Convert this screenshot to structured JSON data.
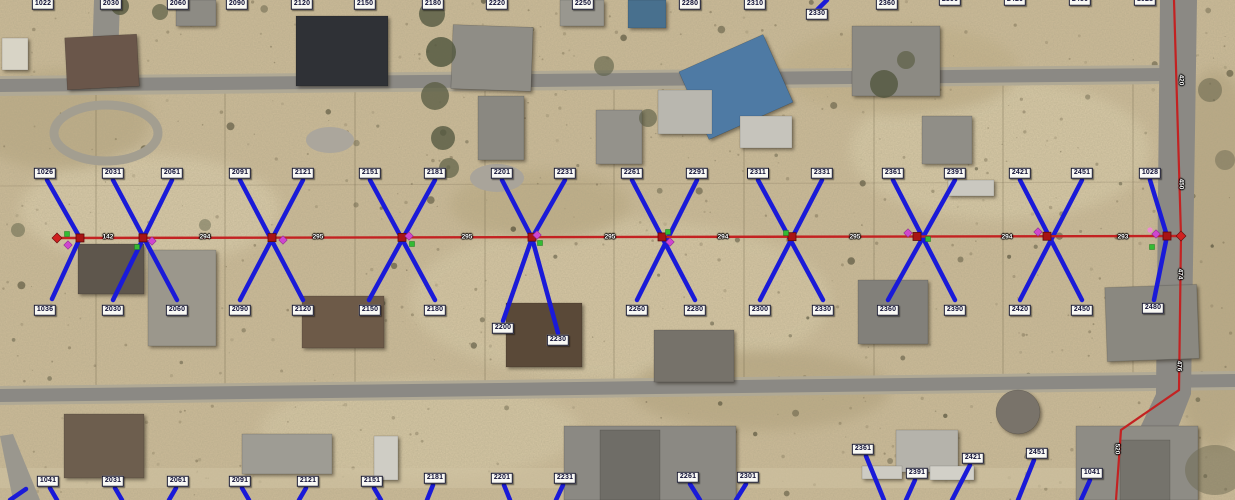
{
  "map": {
    "colors": {
      "drop_blue": "#1a1ad8",
      "line_red": "#c32222",
      "node_red": "#a81414",
      "marker_green": "#33bb33",
      "marker_magenta": "#cf46cf",
      "marker_pink": "#ef8ad2",
      "label_bg": "#f9f9f5",
      "label_text": "#0e0e34"
    },
    "address_labels": {
      "top_row": [
        {
          "t": "1022",
          "x": 43,
          "y": 4
        },
        {
          "t": "2030",
          "x": 111,
          "y": 4
        },
        {
          "t": "2060",
          "x": 178,
          "y": 4
        },
        {
          "t": "2090",
          "x": 237,
          "y": 4
        },
        {
          "t": "2120",
          "x": 302,
          "y": 4
        },
        {
          "t": "2150",
          "x": 365,
          "y": 4
        },
        {
          "t": "2180",
          "x": 433,
          "y": 4
        },
        {
          "t": "2220",
          "x": 497,
          "y": 4
        },
        {
          "t": "2250",
          "x": 583,
          "y": 4
        },
        {
          "t": "2280",
          "x": 690,
          "y": 4
        },
        {
          "t": "2310",
          "x": 755,
          "y": 4
        },
        {
          "t": "2330",
          "x": 817,
          "y": 14
        },
        {
          "t": "2360",
          "x": 887,
          "y": 4
        },
        {
          "t": "2390",
          "x": 950,
          "y": 0
        },
        {
          "t": "2420",
          "x": 1015,
          "y": 0
        },
        {
          "t": "2450",
          "x": 1080,
          "y": 0
        },
        {
          "t": "1028",
          "x": 1145,
          "y": 0
        }
      ],
      "north_drop_row": [
        {
          "t": "1026",
          "x": 45,
          "y": 173
        },
        {
          "t": "2031",
          "x": 113,
          "y": 173
        },
        {
          "t": "2061",
          "x": 172,
          "y": 173
        },
        {
          "t": "2091",
          "x": 240,
          "y": 173
        },
        {
          "t": "2121",
          "x": 303,
          "y": 173
        },
        {
          "t": "2151",
          "x": 370,
          "y": 173
        },
        {
          "t": "2181",
          "x": 435,
          "y": 173
        },
        {
          "t": "2201",
          "x": 502,
          "y": 173
        },
        {
          "t": "2231",
          "x": 565,
          "y": 173
        },
        {
          "t": "2261",
          "x": 632,
          "y": 173
        },
        {
          "t": "2291",
          "x": 697,
          "y": 173
        },
        {
          "t": "2311",
          "x": 758,
          "y": 173
        },
        {
          "t": "2331",
          "x": 822,
          "y": 173
        },
        {
          "t": "2361",
          "x": 893,
          "y": 173
        },
        {
          "t": "2391",
          "x": 955,
          "y": 173
        },
        {
          "t": "2421",
          "x": 1020,
          "y": 173
        },
        {
          "t": "2451",
          "x": 1082,
          "y": 173
        },
        {
          "t": "1028",
          "x": 1150,
          "y": 173
        }
      ],
      "south_drop_row": [
        {
          "t": "1036",
          "x": 45,
          "y": 310
        },
        {
          "t": "2030",
          "x": 113,
          "y": 310
        },
        {
          "t": "2060",
          "x": 177,
          "y": 310
        },
        {
          "t": "2090",
          "x": 240,
          "y": 310
        },
        {
          "t": "2120",
          "x": 303,
          "y": 310
        },
        {
          "t": "2150",
          "x": 370,
          "y": 310
        },
        {
          "t": "2180",
          "x": 435,
          "y": 310
        },
        {
          "t": "2200",
          "x": 503,
          "y": 328
        },
        {
          "t": "2230",
          "x": 558,
          "y": 340
        },
        {
          "t": "2260",
          "x": 637,
          "y": 310
        },
        {
          "t": "2280",
          "x": 695,
          "y": 310
        },
        {
          "t": "2300",
          "x": 760,
          "y": 310
        },
        {
          "t": "2330",
          "x": 823,
          "y": 310
        },
        {
          "t": "2360",
          "x": 888,
          "y": 310
        },
        {
          "t": "2390",
          "x": 955,
          "y": 310
        },
        {
          "t": "2420",
          "x": 1020,
          "y": 310
        },
        {
          "t": "2450",
          "x": 1082,
          "y": 310
        },
        {
          "t": "2480",
          "x": 1153,
          "y": 308
        }
      ],
      "bottom_row": [
        {
          "t": "1041",
          "x": 48,
          "y": 481
        },
        {
          "t": "2031",
          "x": 113,
          "y": 481
        },
        {
          "t": "2061",
          "x": 178,
          "y": 481
        },
        {
          "t": "2091",
          "x": 240,
          "y": 481
        },
        {
          "t": "2121",
          "x": 308,
          "y": 481
        },
        {
          "t": "2151",
          "x": 372,
          "y": 481
        },
        {
          "t": "2181",
          "x": 435,
          "y": 478
        },
        {
          "t": "2201",
          "x": 502,
          "y": 478
        },
        {
          "t": "2231",
          "x": 565,
          "y": 478
        },
        {
          "t": "2261",
          "x": 688,
          "y": 477
        },
        {
          "t": "2301",
          "x": 748,
          "y": 477
        },
        {
          "t": "2361",
          "x": 863,
          "y": 449
        },
        {
          "t": "2391",
          "x": 917,
          "y": 473
        },
        {
          "t": "2421",
          "x": 973,
          "y": 458
        },
        {
          "t": "2451",
          "x": 1037,
          "y": 453
        },
        {
          "t": "1041",
          "x": 1092,
          "y": 473
        }
      ]
    },
    "main_line": {
      "start": [
        57,
        238
      ],
      "end": [
        1181,
        236
      ],
      "nodes_x": [
        80,
        143,
        272,
        402,
        532,
        662,
        792,
        917,
        1047,
        1167
      ],
      "distances": [
        {
          "t": "142",
          "x": 108
        },
        {
          "t": "294",
          "x": 205
        },
        {
          "t": "295",
          "x": 318
        },
        {
          "t": "295",
          "x": 467
        },
        {
          "t": "295",
          "x": 610
        },
        {
          "t": "294",
          "x": 723
        },
        {
          "t": "295",
          "x": 855
        },
        {
          "t": "294",
          "x": 1007
        },
        {
          "t": "293",
          "x": 1123
        }
      ]
    },
    "road_line": {
      "points": [
        [
          1174,
          0
        ],
        [
          1181,
          236
        ],
        [
          1179,
          390
        ],
        [
          1121,
          430
        ],
        [
          1116,
          500
        ]
      ],
      "labels": [
        {
          "t": "420",
          "x": 1181,
          "y": 80
        },
        {
          "t": "450",
          "x": 1181,
          "y": 184
        },
        {
          "t": "474",
          "x": 1180,
          "y": 274
        },
        {
          "t": "476",
          "x": 1179,
          "y": 366
        },
        {
          "t": "520",
          "x": 1117,
          "y": 449
        }
      ]
    },
    "drops": {
      "segments": [
        [
          113,
          180,
          177,
          300
        ],
        [
          172,
          180,
          113,
          300
        ],
        [
          240,
          180,
          303,
          300
        ],
        [
          303,
          180,
          240,
          300
        ],
        [
          370,
          180,
          435,
          300
        ],
        [
          435,
          180,
          369,
          300
        ],
        [
          632,
          180,
          695,
          300
        ],
        [
          697,
          180,
          637,
          300
        ],
        [
          758,
          180,
          823,
          300
        ],
        [
          822,
          180,
          760,
          300
        ],
        [
          893,
          180,
          955,
          300
        ],
        [
          955,
          180,
          888,
          300
        ],
        [
          1020,
          180,
          1082,
          300
        ],
        [
          1082,
          180,
          1020,
          300
        ],
        [
          50,
          488,
          57,
          500
        ],
        [
          115,
          488,
          122,
          500
        ],
        [
          176,
          488,
          169,
          500
        ],
        [
          242,
          488,
          249,
          500
        ],
        [
          306,
          488,
          299,
          500
        ],
        [
          374,
          488,
          381,
          500
        ],
        [
          433,
          485,
          427,
          500
        ],
        [
          504,
          485,
          510,
          500
        ],
        [
          563,
          485,
          556,
          500
        ],
        [
          690,
          484,
          700,
          500
        ],
        [
          746,
          484,
          736,
          500
        ],
        [
          866,
          456,
          884,
          500
        ],
        [
          915,
          480,
          906,
          500
        ],
        [
          970,
          465,
          952,
          500
        ],
        [
          1034,
          460,
          1018,
          500
        ],
        [
          1090,
          480,
          1081,
          500
        ],
        [
          10,
          500,
          26,
          489
        ]
      ],
      "polylines": [
        [
          [
            47,
            180
          ],
          [
            80,
            238
          ],
          [
            52,
            299
          ]
        ],
        [
          [
            1150,
            180
          ],
          [
            1167,
            236
          ],
          [
            1154,
            300
          ]
        ],
        [
          [
            827,
            0
          ],
          [
            817,
            10
          ]
        ],
        [
          [
            502,
            180
          ],
          [
            532,
            238
          ],
          [
            558,
            333
          ]
        ],
        [
          [
            565,
            180
          ],
          [
            532,
            238
          ],
          [
            503,
            321
          ]
        ]
      ]
    },
    "markers": {
      "green_squares": [
        [
          67,
          234
        ],
        [
          137,
          247
        ],
        [
          412,
          244
        ],
        [
          540,
          243
        ],
        [
          668,
          232
        ],
        [
          786,
          233
        ],
        [
          928,
          239
        ],
        [
          1152,
          247
        ]
      ],
      "magenta_diamonds": [
        [
          68,
          245
        ],
        [
          152,
          241
        ],
        [
          283,
          240
        ],
        [
          409,
          236
        ],
        [
          537,
          235
        ],
        [
          670,
          242
        ],
        [
          908,
          233
        ],
        [
          1038,
          232
        ],
        [
          1156,
          234
        ]
      ],
      "pink_circles": [
        [
          1150,
          230
        ]
      ],
      "end_diamonds": [
        [
          57,
          238
        ],
        [
          1181,
          236
        ]
      ]
    }
  }
}
